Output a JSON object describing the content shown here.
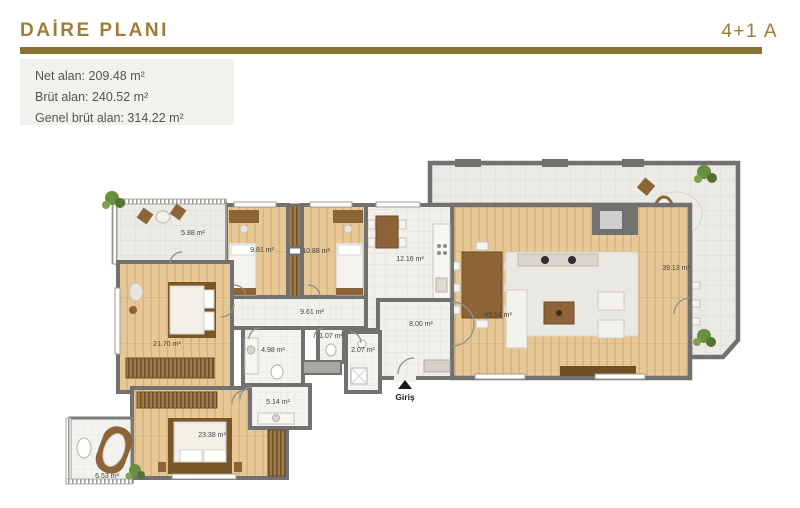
{
  "header": {
    "title": "DAİRE PLANI",
    "unit": "4+1 A"
  },
  "info": {
    "lines": [
      "Net alan: 209.48 m²",
      "Brüt alan: 240.52 m²",
      "Genel brüt alan: 314.22 m²"
    ]
  },
  "plan": {
    "entrance_label": "Giriş",
    "rooms": [
      {
        "name": "balcony-top",
        "area": "5.88 m²"
      },
      {
        "name": "bedroom-1",
        "area": "9.81 m²"
      },
      {
        "name": "bedroom-2",
        "area": "10.88 m²"
      },
      {
        "name": "kitchen",
        "area": "12.16 m²"
      },
      {
        "name": "hall",
        "area": "9.61 m²"
      },
      {
        "name": "entry-hall",
        "area": "8.00 m²"
      },
      {
        "name": "living-room",
        "area": "49.14 m²"
      },
      {
        "name": "terrace",
        "area": "39.13 m²"
      },
      {
        "name": "bedroom-3",
        "area": "21.70 m²"
      },
      {
        "name": "bathroom-1",
        "area": "4.98 m²"
      },
      {
        "name": "wc",
        "area": "1.07 m²"
      },
      {
        "name": "bathroom-2",
        "area": "2.07 m²"
      },
      {
        "name": "dressing-room",
        "area": "5.14 m²"
      },
      {
        "name": "master-bedroom",
        "area": "23.38 m²"
      },
      {
        "name": "bathroom-3",
        "area": "6.53 m²"
      }
    ]
  },
  "colors": {
    "accent_gold": "#9c7d3a",
    "divider_gold": "#8a7132",
    "wall_gray": "#717171",
    "wood_floor": "#e7c795",
    "info_box_bg": "#f2f1ed"
  }
}
